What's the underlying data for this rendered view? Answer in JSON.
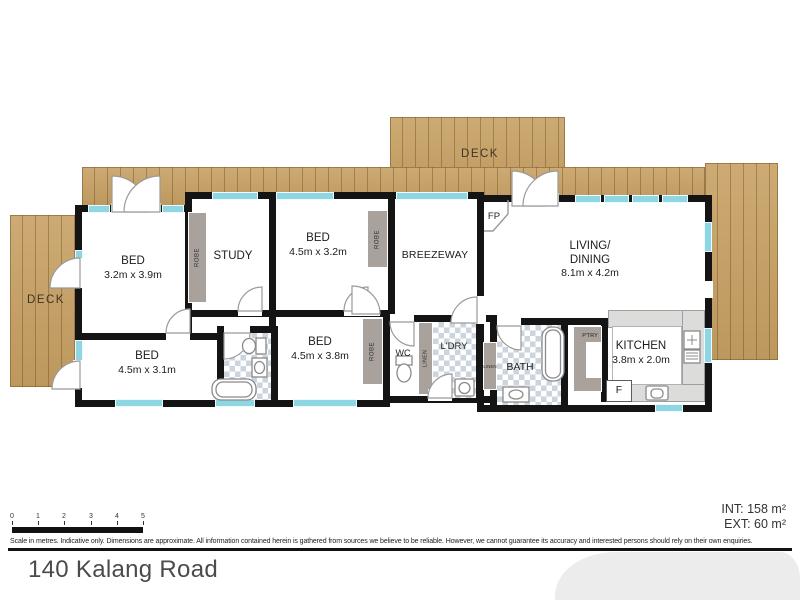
{
  "plan": {
    "decks": {
      "top_label": "DECK",
      "left_label": "DECK"
    },
    "rooms": {
      "bed1": {
        "name": "BED",
        "dims": "3.2m x 3.9m"
      },
      "bed2": {
        "name": "BED",
        "dims": "4.5m x 3.1m"
      },
      "bed3": {
        "name": "BED",
        "dims": "4.5m x 3.2m"
      },
      "bed4": {
        "name": "BED",
        "dims": "4.5m x 3.8m"
      },
      "study": {
        "name": "STUDY"
      },
      "breezeway": {
        "name": "BREEZEWAY"
      },
      "living": {
        "name_line1": "LIVING/",
        "name_line2": "DINING",
        "dims": "8.1m x 4.2m"
      },
      "kitchen": {
        "name": "KITCHEN",
        "dims": "3.8m x 2.0m"
      },
      "bath": {
        "name": "BATH"
      },
      "wc": {
        "name": "WC"
      },
      "laundry": {
        "name": "L'DRY"
      },
      "pantry": {
        "name": "P'TRY"
      },
      "fireplace": {
        "name": "FP"
      },
      "fridge": {
        "name": "F"
      }
    },
    "storage": {
      "robe1": "ROBE",
      "robe2": "ROBE",
      "robe3": "ROBE",
      "linen1": "LINEN",
      "linen2": "LINEN"
    }
  },
  "scale": {
    "ticks": [
      "0",
      "1",
      "2",
      "3",
      "4",
      "5"
    ]
  },
  "footer": {
    "disclaimer": "Scale in metres. Indicative only. Dimensions are approximate. All information contained herein is gathered from sources we believe to be reliable. However, we cannot guarantee its accuracy and interested persons should rely on their own enquiries.",
    "int_area": "INT: 158 m²",
    "ext_area": "EXT: 60 m²",
    "address": "140 Kalang Road"
  },
  "colors": {
    "deck": "#c8a164",
    "wall": "#141414",
    "window": "#8ed6e2",
    "storage_gray": "#a9a19b",
    "checker": "#ccd4dd",
    "counter": "#dcdcda"
  }
}
